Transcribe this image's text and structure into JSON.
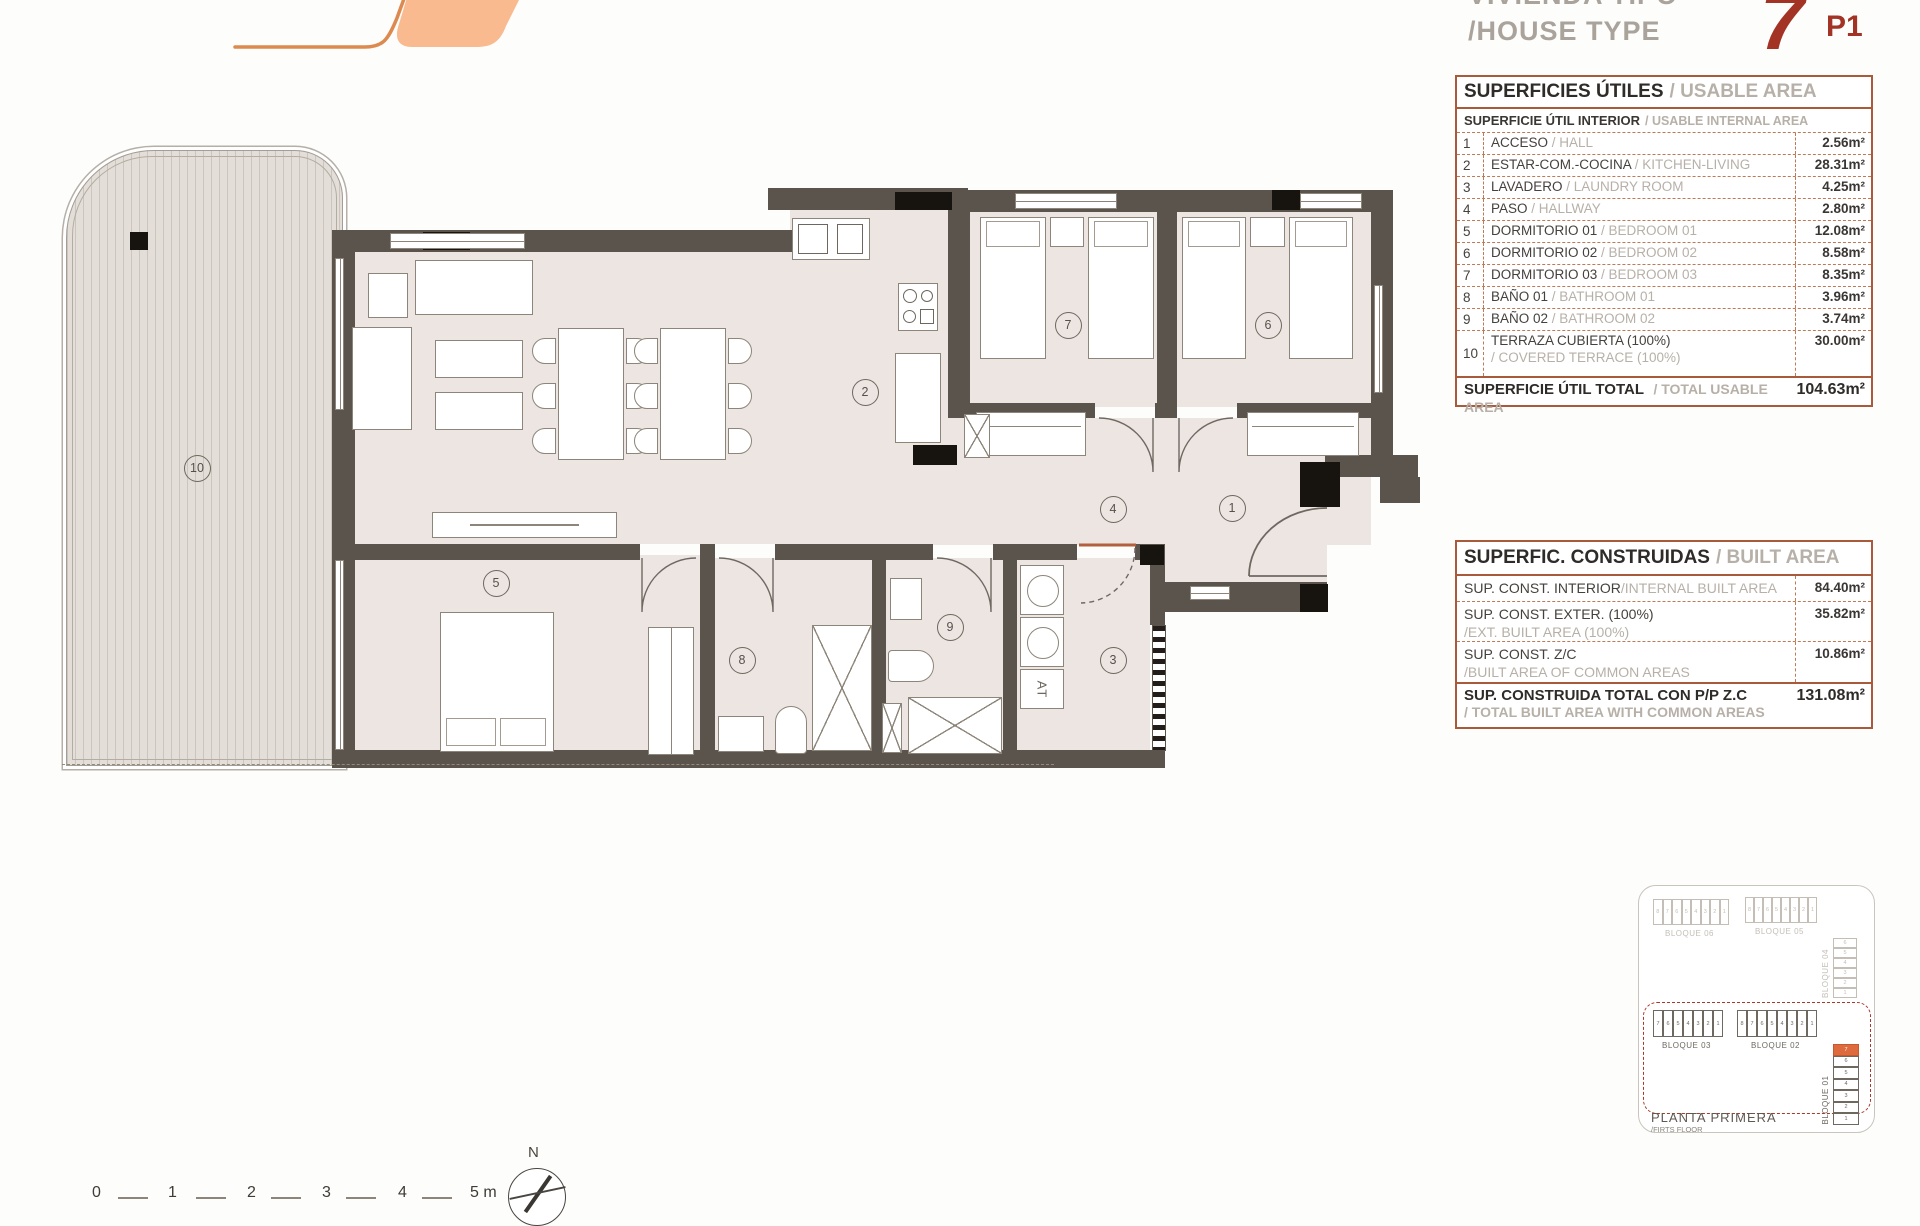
{
  "header": {
    "title_es": "VIVIENDA TIPO",
    "title_en": "/HOUSE TYPE",
    "unit_number": "7",
    "unit_code": "P1"
  },
  "usable_area_table": {
    "title_es": "SUPERFICIES ÚTILES",
    "title_en": "/ USABLE AREA",
    "subtitle_es": "SUPERFICIE ÚTIL INTERIOR",
    "subtitle_en": "/ USABLE INTERNAL AREA",
    "rows": [
      {
        "num": "1",
        "es": "ACCESO",
        "en": "/ HALL",
        "value": "2.56m²",
        "two_line": false
      },
      {
        "num": "2",
        "es": "ESTAR-COM.-COCINA",
        "en": "/ KITCHEN-LIVING",
        "value": "28.31m²",
        "two_line": false
      },
      {
        "num": "3",
        "es": "LAVADERO",
        "en": "/ LAUNDRY ROOM",
        "value": "4.25m²",
        "two_line": false
      },
      {
        "num": "4",
        "es": "PASO",
        "en": "/ HALLWAY",
        "value": "2.80m²",
        "two_line": false
      },
      {
        "num": "5",
        "es": "DORMITORIO 01",
        "en": "/ BEDROOM 01",
        "value": "12.08m²",
        "two_line": false
      },
      {
        "num": "6",
        "es": "DORMITORIO 02",
        "en": "/ BEDROOM 02",
        "value": "8.58m²",
        "two_line": false
      },
      {
        "num": "7",
        "es": "DORMITORIO 03",
        "en": "/ BEDROOM 03",
        "value": "8.35m²",
        "two_line": false
      },
      {
        "num": "8",
        "es": "BAÑO 01",
        "en": "/ BATHROOM 01",
        "value": "3.96m²",
        "two_line": false
      },
      {
        "num": "9",
        "es": "BAÑO 02",
        "en": "/ BATHROOM 02",
        "value": "3.74m²",
        "two_line": false
      },
      {
        "num": "10",
        "es": "TERRAZA CUBIERTA (100%)",
        "en": "/ COVERED TERRACE (100%)",
        "value": "30.00m²",
        "two_line": true
      }
    ],
    "total_es": "SUPERFICIE ÚTIL TOTAL",
    "total_en": "/ TOTAL USABLE AREA",
    "total_value": "104.63m²"
  },
  "built_area_table": {
    "title_es": "SUPERFIC. CONSTRUIDAS",
    "title_en": "/ BUILT AREA",
    "rows": [
      {
        "es": "SUP. CONST. INTERIOR",
        "en": "/INTERNAL BUILT AREA",
        "value": "84.40m²",
        "two_line": false
      },
      {
        "es": "SUP. CONST. EXTER. (100%)",
        "en": "/EXT. BUILT AREA (100%)",
        "value": "35.82m²",
        "two_line": true
      },
      {
        "es": "SUP. CONST. Z/C",
        "en": "/BUILT AREA OF COMMON AREAS",
        "value": "10.86m²",
        "two_line": true
      }
    ],
    "total_es": "SUP. CONSTRUIDA TOTAL CON P/P Z.C",
    "total_en": "/ TOTAL BUILT AREA WITH COMMON AREAS",
    "total_value": "131.08m²"
  },
  "floor_plan": {
    "room_labels": [
      {
        "num": "1",
        "x": 1232,
        "y": 508
      },
      {
        "num": "2",
        "x": 865,
        "y": 392
      },
      {
        "num": "3",
        "x": 1113,
        "y": 660
      },
      {
        "num": "4",
        "x": 1113,
        "y": 509
      },
      {
        "num": "5",
        "x": 496,
        "y": 583
      },
      {
        "num": "6",
        "x": 1268,
        "y": 325
      },
      {
        "num": "7",
        "x": 1068,
        "y": 325
      },
      {
        "num": "8",
        "x": 742,
        "y": 660
      },
      {
        "num": "9",
        "x": 950,
        "y": 627
      },
      {
        "num": "10",
        "x": 197,
        "y": 468
      }
    ],
    "equipment_label": "AT"
  },
  "site_plan": {
    "blocks": [
      {
        "name": "BLOQUE 06",
        "cells": [
          "8",
          "7",
          "6",
          "5",
          "4",
          "3",
          "2",
          "1"
        ],
        "style": "light",
        "orient": "h",
        "x": 14,
        "y": 13,
        "cw": 9.5,
        "ch": 26
      },
      {
        "name": "BLOQUE 05",
        "cells": [
          "8",
          "7",
          "6",
          "5",
          "4",
          "3",
          "2",
          "1"
        ],
        "style": "light",
        "orient": "h",
        "x": 106,
        "y": 11,
        "cw": 9,
        "ch": 26
      },
      {
        "name": "BLOQUE 04",
        "cells": [
          "6",
          "5",
          "4",
          "3",
          "2",
          "1"
        ],
        "style": "light",
        "orient": "v",
        "x": 194,
        "y": 52,
        "cw": 24,
        "ch": 10
      },
      {
        "name": "BLOQUE 03",
        "cells": [
          "7",
          "6",
          "5",
          "4",
          "3",
          "2",
          "1"
        ],
        "style": "dark",
        "orient": "h",
        "x": 14,
        "y": 124,
        "cw": 10,
        "ch": 27
      },
      {
        "name": "BLOQUE 02",
        "cells": [
          "8",
          "7",
          "6",
          "5",
          "4",
          "3",
          "2",
          "1"
        ],
        "style": "dark",
        "orient": "h",
        "x": 98,
        "y": 124,
        "cw": 10,
        "ch": 27
      },
      {
        "name": "BLOQUE 01",
        "cells": [
          "7",
          "6",
          "5",
          "4",
          "3",
          "2",
          "1"
        ],
        "style": "dark",
        "orient": "v",
        "x": 194,
        "y": 158,
        "cw": 26,
        "ch": 11.5,
        "highlight": "7"
      }
    ],
    "caption_line1": "PLANTA PRIMERA",
    "caption_line2": "/FIRTS FLOOR"
  },
  "scale_bar": {
    "labels": [
      "0",
      "1",
      "2",
      "3",
      "4",
      "5 m"
    ]
  },
  "compass": {
    "label": "N"
  },
  "colors": {
    "accent_orange": "#f8ba8e",
    "accent_orange_line": "#dd8a50",
    "table_border": "#a85a3a",
    "highlight_red": "#a23325",
    "wall": "#5b544d",
    "site_highlight": "#dd6b3d"
  }
}
